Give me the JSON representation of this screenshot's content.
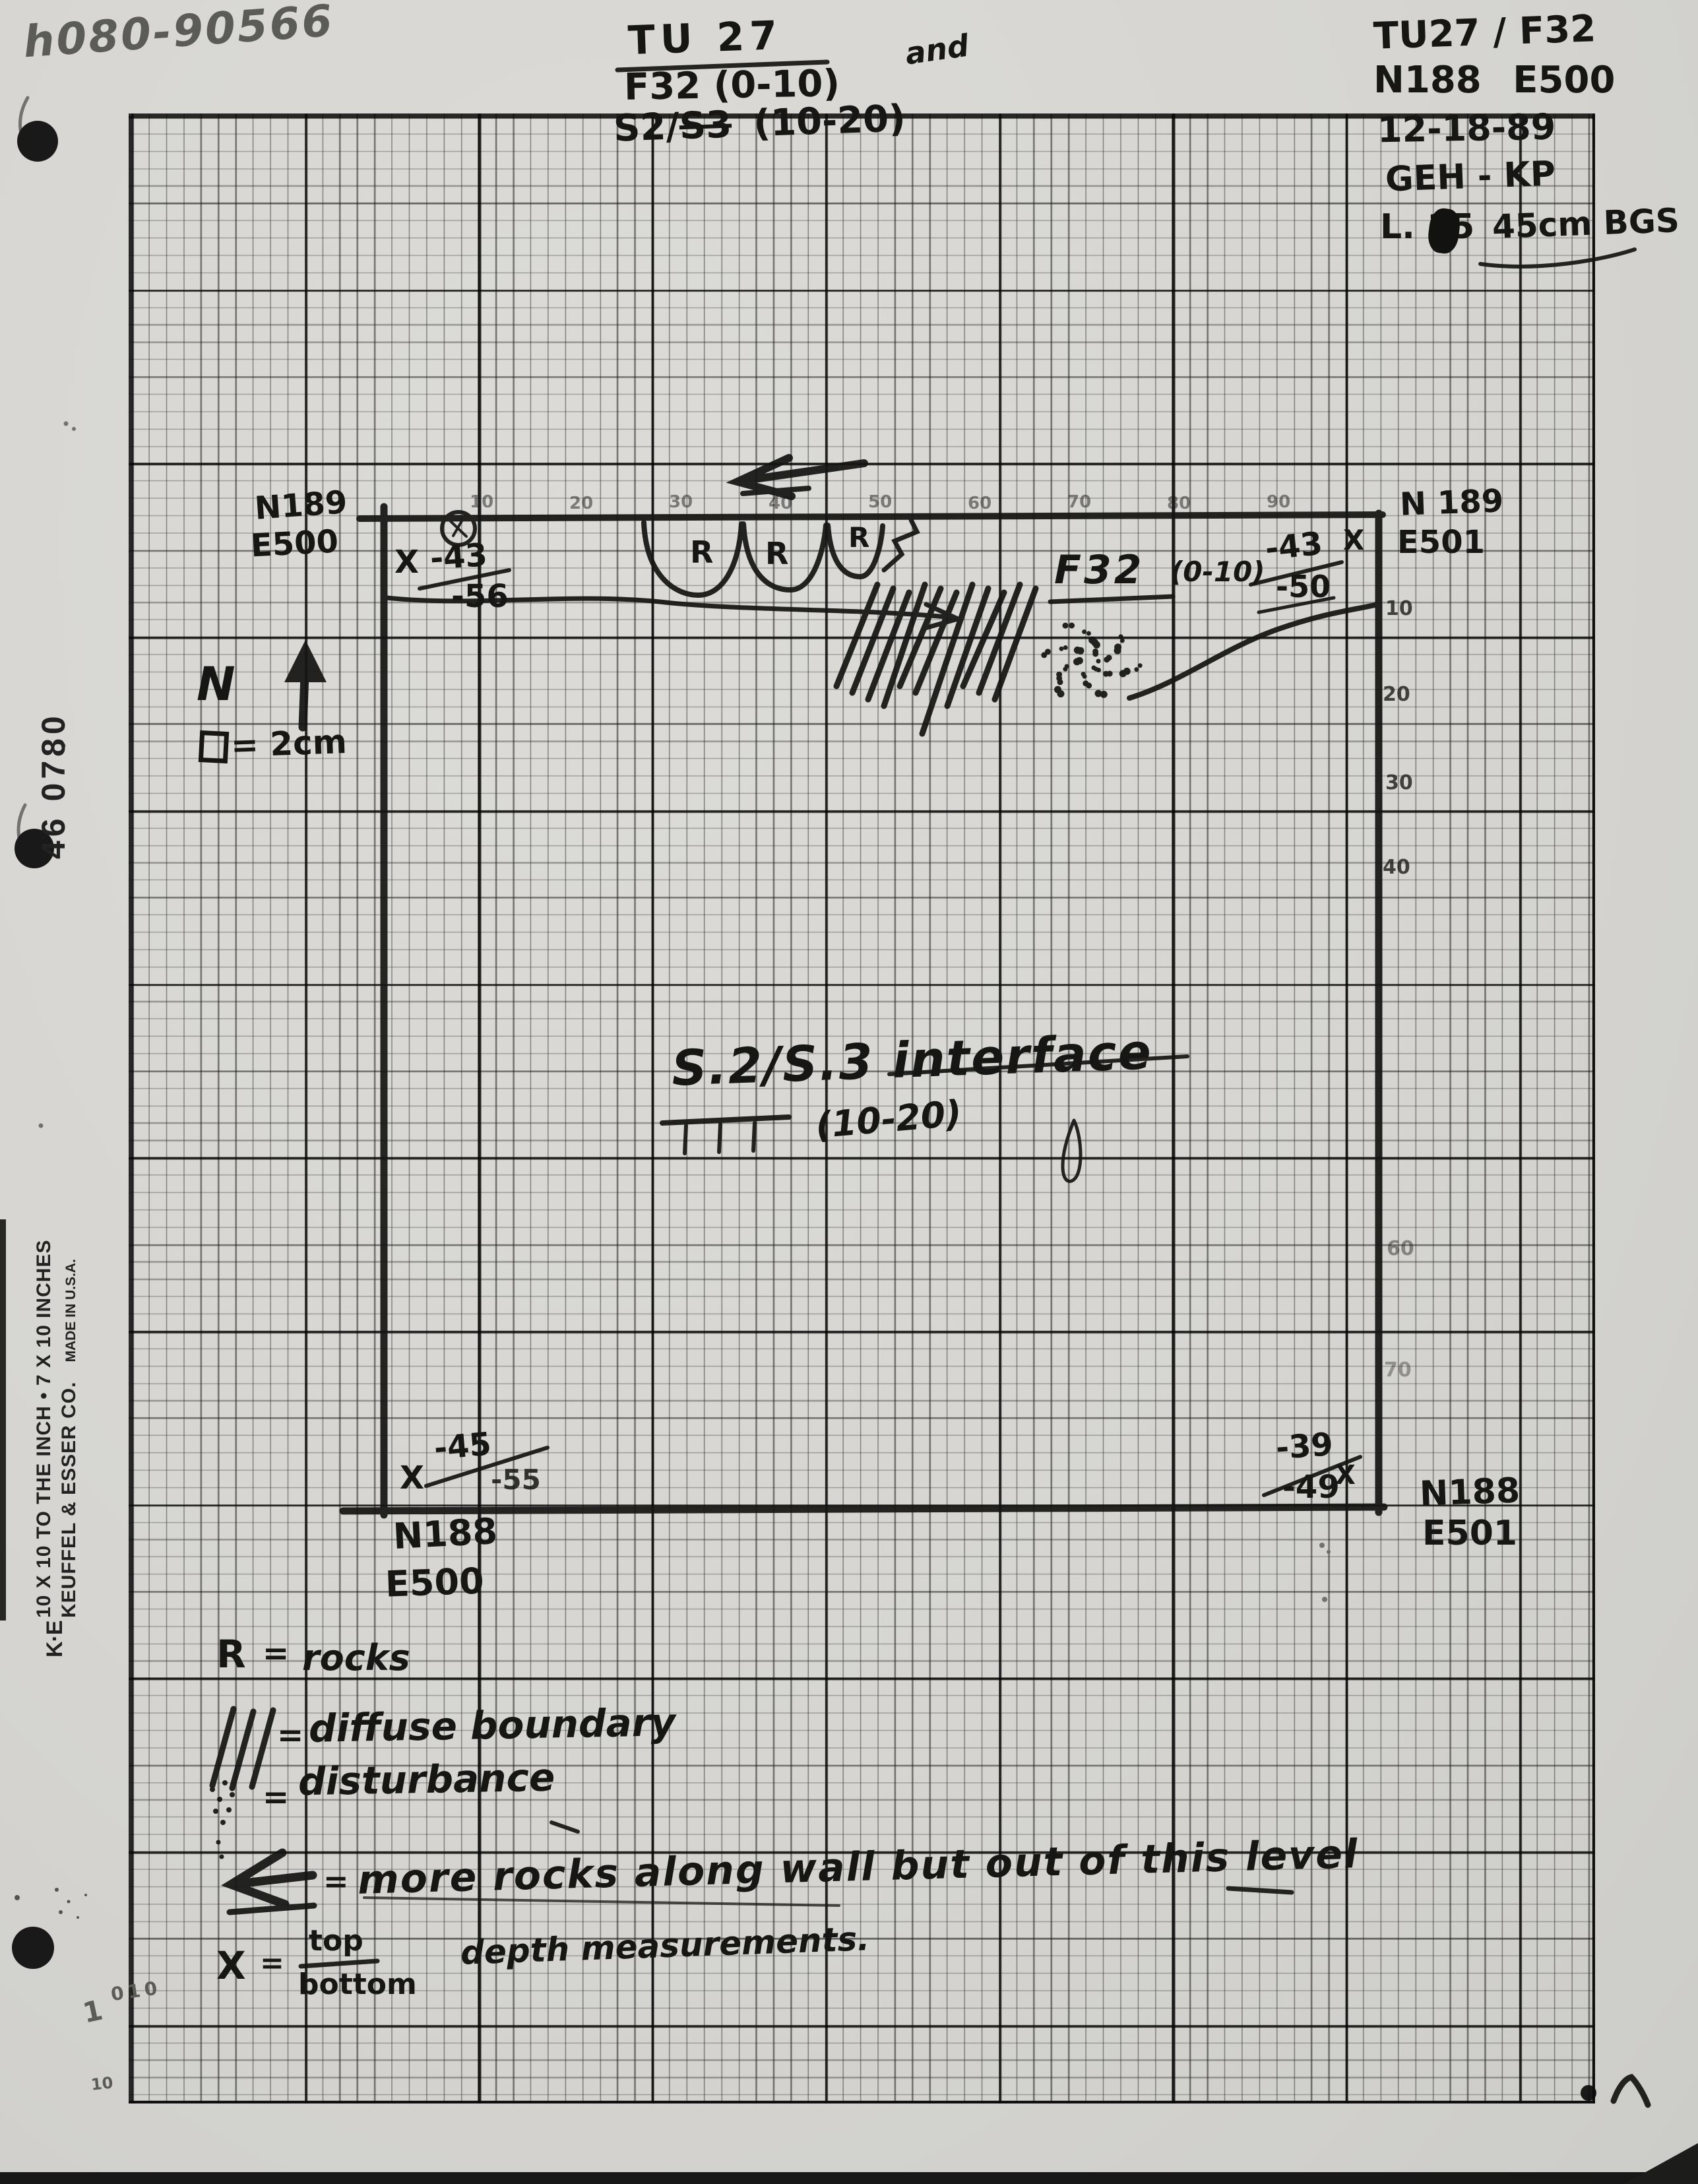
{
  "page": {
    "catalog_number": "h080-90566",
    "page_number_mark": "7"
  },
  "title_block": {
    "unit_title": "TU 27",
    "feature_line": "F32 (0-10)",
    "conjunction": "and",
    "strata_prefix": "S2/",
    "strata_struck": "S3",
    "strata_suffix": "(10-20)"
  },
  "header_right": {
    "unit_feature": "TU27 / F32",
    "grid_coord": "N188 E500",
    "date": "12-18-89",
    "crew": "GEH - KP",
    "level": "L. 15",
    "depth": "45cm BGS"
  },
  "compass": {
    "north_label": "N",
    "scale_symbol": "□",
    "scale_text": "= 2cm"
  },
  "unit": {
    "corners": {
      "nw": {
        "coord_n": "N189",
        "coord_e": "E500",
        "x_mark": "X",
        "depth_top": "-43",
        "depth_bottom": "-56"
      },
      "ne": {
        "coord_n": "N 189",
        "coord_e": "E501",
        "x_mark": "X",
        "depth_top": "-43",
        "depth_bottom": "-50"
      },
      "sw": {
        "coord_n": "N188",
        "coord_e": "E500",
        "x_mark": "X",
        "depth_top": "-45",
        "depth_bottom": "-55"
      },
      "se": {
        "coord_n": "N188",
        "coord_e": "E501",
        "x_mark": "X",
        "depth_top": "-39",
        "depth_bottom": "-49"
      }
    },
    "feature_label": "F32",
    "feature_range": "(0-10)",
    "interface_label": "S.2/S.3 interface",
    "interface_range": "(10-20)",
    "rock_labels": [
      "R",
      "R",
      "R"
    ],
    "top_edge_marks": [
      "10",
      "20",
      "30",
      "40",
      "50",
      "60",
      "70",
      "80",
      "90"
    ],
    "right_edge_marks": [
      "10",
      "20",
      "30",
      "40",
      "60",
      "70"
    ]
  },
  "legend": {
    "items": [
      {
        "symbol": "R",
        "sep": "=",
        "text": "rocks"
      },
      {
        "symbol": "///",
        "sep": "=",
        "text": "diffuse boundary"
      },
      {
        "symbol": "∴",
        "sep": "=",
        "text": "disturbance"
      },
      {
        "symbol": "⟸",
        "sep": "=",
        "text": "more rocks along wall but out of this level"
      },
      {
        "symbol": "X",
        "sep": "=",
        "fraction_top": "top",
        "fraction_bottom": "bottom",
        "text": "depth measurements."
      }
    ]
  },
  "paper": {
    "stock_number": "46 0780",
    "brand_line1": "10 X 10 TO THE INCH • 7 X 10 INCHES",
    "brand_line2": "KEUFFEL & ESSER CO.",
    "brand_made": "MADE IN U.S.A.",
    "logo": "K·E"
  },
  "margin_marks": {
    "pencil_a": "1",
    "pencil_b": "010",
    "pencil_c": "10"
  }
}
